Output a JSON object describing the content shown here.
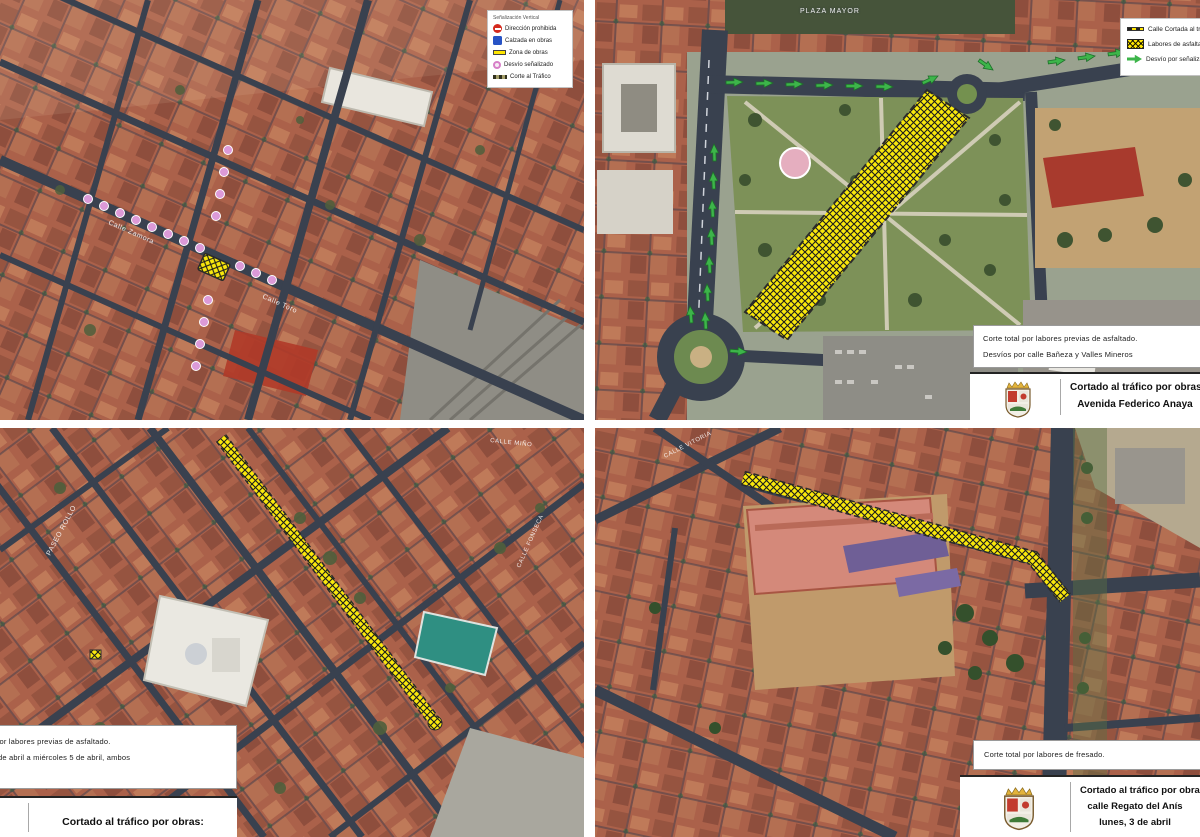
{
  "top_left": {
    "legend": {
      "title": "Señalización Vertical",
      "items": [
        {
          "icon": "no-entry-icon",
          "label": "Dirección prohibida"
        },
        {
          "icon": "blue-square-sign-icon",
          "label": "Calzada en obras"
        },
        {
          "icon": "works-zone-icon",
          "label": "Zona de obras"
        },
        {
          "icon": "signed-detour-icon",
          "label": "Desvío señalizado"
        },
        {
          "icon": "traffic-cut-icon",
          "label": "Corte al Tráfico"
        }
      ]
    },
    "street_labels": {
      "a": "Calle Zamora",
      "b": "Calle Toro"
    }
  },
  "top_right": {
    "map_label": "PLAZA MAYOR",
    "legend": {
      "items": [
        {
          "icon": "cut-street-line-icon",
          "label": "Calle Cortada al tráfico"
        },
        {
          "icon": "asphalt-works-icon",
          "label": "Labores de asfaltado"
        },
        {
          "icon": "detour-arrow-icon",
          "label": "Desvío por señalizar"
        }
      ]
    },
    "info": {
      "line1": "Corte total por labores previas de asfaltado.",
      "line2": "Desvíos por calle Bañeza y Valles Mineros"
    },
    "banner": {
      "line1": "Cortado al tráfico por obras:",
      "line2": "Avenida Federico Anaya"
    }
  },
  "bottom_left": {
    "street_labels": {
      "a": "PASEO ROLLO",
      "b": "CALLE MIÑO",
      "c": "CALLE FONSECA"
    },
    "info": {
      "line1": "Corte total por labores previas de asfaltado.",
      "line2": "Del lunes 3 de abril a miércoles 5 de abril, ambos"
    },
    "banner": {
      "line1": "Cortado al tráfico por obras:"
    }
  },
  "bottom_right": {
    "street_labels": {
      "a": "CALLE VITORIA"
    },
    "info": {
      "line1": "Corte total por labores de fresado."
    },
    "banner": {
      "line1": "Cortado al tráfico por obras:",
      "line2": "calle Regato del Anís",
      "line3": "lunes, 3 de abril"
    }
  },
  "colors": {
    "works_yellow": "#f9e80c",
    "detour_green": "#3db54a",
    "detour_pink": "#dc9ad8",
    "road_dark": "#39414f",
    "roof_red": "#ab614a"
  }
}
